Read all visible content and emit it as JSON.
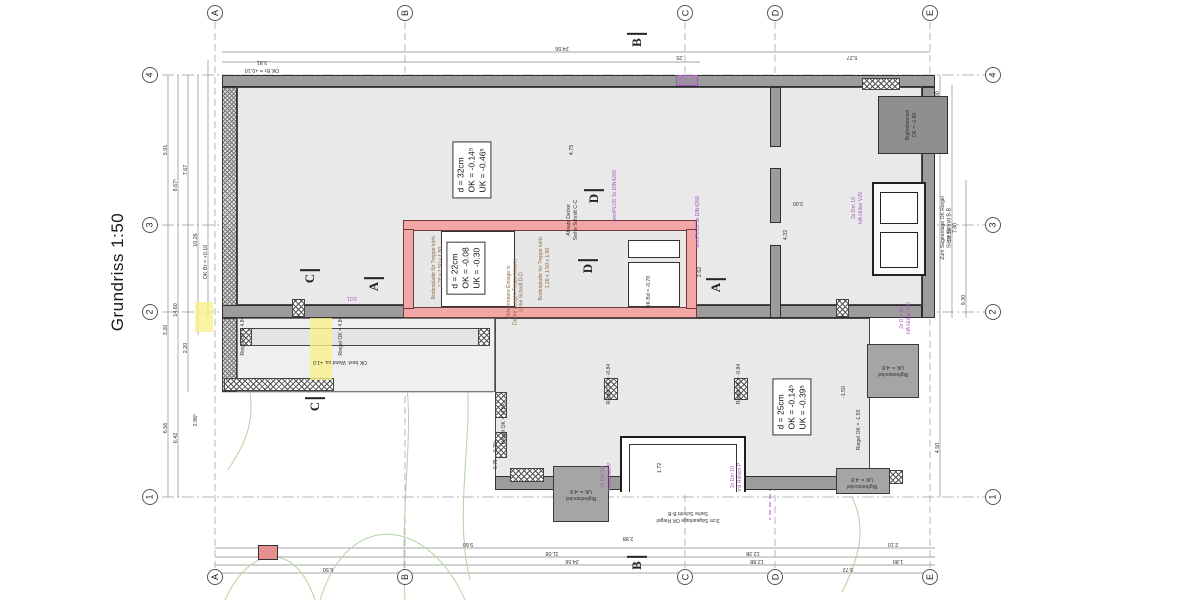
{
  "title": "Grundriss 1:50",
  "colors": {
    "new_construction_pink": "#f2a6a6",
    "existing_wall_gray": "#9c9c9c",
    "annotation_purple": "#a855c0",
    "highlight_yellow": "#f6ef9f",
    "contour_green": "#aed6a0"
  },
  "grid": {
    "cols": [
      {
        "label": "A",
        "x": 215
      },
      {
        "label": "B",
        "x": 405
      },
      {
        "label": "C",
        "x": 685
      },
      {
        "label": "D",
        "x": 775
      },
      {
        "label": "E",
        "x": 930
      }
    ],
    "rows": [
      {
        "label": "4",
        "y": 75
      },
      {
        "label": "3",
        "y": 225
      },
      {
        "label": "2",
        "y": 312
      },
      {
        "label": "1",
        "y": 497
      }
    ]
  },
  "annotation_boxes": [
    {
      "lines": "d = 32cm\nOK = -0.14⁵\nUK = -0.46⁵",
      "cx": 472,
      "cy": 170
    },
    {
      "lines": "d = 22cm\nOK = -0.08\nUK = -0.30",
      "cx": 466,
      "cy": 268
    },
    {
      "lines": "d = 25cm\nOK = -0.14⁵\nUK = -0.39⁵",
      "cx": 792,
      "cy": 407
    }
  ],
  "section_markers": [
    {
      "label": "B",
      "x": 637,
      "y": 40
    },
    {
      "label": "B",
      "x": 637,
      "y": 563
    },
    {
      "label": "C",
      "x": 310,
      "y": 276
    },
    {
      "label": "C",
      "x": 315,
      "y": 404
    },
    {
      "label": "A",
      "x": 374,
      "y": 284
    },
    {
      "label": "A",
      "x": 716,
      "y": 285
    },
    {
      "label": "D",
      "x": 594,
      "y": 196
    },
    {
      "label": "D",
      "x": 588,
      "y": 266
    }
  ],
  "dimensions": [
    {
      "t": "24.56",
      "x": 562,
      "y": 48,
      "r": 180
    },
    {
      "t": "5.27",
      "x": 852,
      "y": 57,
      "r": 180
    },
    {
      "t": ".25",
      "x": 680,
      "y": 57,
      "r": 180
    },
    {
      "t": "3.81",
      "x": 262,
      "y": 62,
      "r": 180
    },
    {
      "t": "OK Br = +0.10",
      "x": 262,
      "y": 70,
      "r": 180
    },
    {
      "t": "9.60",
      "x": 468,
      "y": 544,
      "r": 180
    },
    {
      "t": "2.10",
      "x": 893,
      "y": 544,
      "r": 180
    },
    {
      "t": "11.08",
      "x": 552,
      "y": 553,
      "r": 180
    },
    {
      "t": "12.38",
      "x": 753,
      "y": 553,
      "r": 180
    },
    {
      "t": "24.56",
      "x": 572,
      "y": 561,
      "r": 180
    },
    {
      "t": "12.88",
      "x": 757,
      "y": 561,
      "r": 180
    },
    {
      "t": "6.50",
      "x": 328,
      "y": 569,
      "r": 180
    },
    {
      "t": "9.72",
      "x": 848,
      "y": 569,
      "r": 180
    },
    {
      "t": "1.80",
      "x": 898,
      "y": 561,
      "r": 180
    },
    {
      "t": "2.88",
      "x": 628,
      "y": 538,
      "r": 180
    },
    {
      "t": "5.91",
      "x": 166,
      "y": 150,
      "r": -90
    },
    {
      "t": "7.67",
      "x": 186,
      "y": 170,
      "r": -90
    },
    {
      "t": "8.67⁵",
      "x": 176,
      "y": 185,
      "r": -90
    },
    {
      "t": "10.26",
      "x": 196,
      "y": 240,
      "r": -90
    },
    {
      "t": "OK Br = +0.10",
      "x": 206,
      "y": 262,
      "r": -90
    },
    {
      "t": "14.60",
      "x": 176,
      "y": 310,
      "r": -90
    },
    {
      "t": "3.20",
      "x": 166,
      "y": 330,
      "r": -90
    },
    {
      "t": "2.20",
      "x": 186,
      "y": 348,
      "r": -90
    },
    {
      "t": "6.56",
      "x": 166,
      "y": 428,
      "r": -90
    },
    {
      "t": "6.42",
      "x": 176,
      "y": 438,
      "r": -90
    },
    {
      "t": "2.86⁵",
      "x": 196,
      "y": 420,
      "r": -90
    },
    {
      "t": ".90",
      "x": 938,
      "y": 95,
      "r": -90
    },
    {
      "t": "10.50",
      "x": 950,
      "y": 235,
      "r": -90
    },
    {
      "t": "9.30",
      "x": 964,
      "y": 300,
      "r": -90
    },
    {
      "t": "4.50",
      "x": 938,
      "y": 448,
      "r": -90
    },
    {
      "t": "4.75",
      "x": 572,
      "y": 150,
      "r": -90
    },
    {
      "t": "4.32",
      "x": 786,
      "y": 235,
      "r": -90
    },
    {
      "t": "3.00",
      "x": 798,
      "y": 203,
      "r": 180
    },
    {
      "t": "1.72",
      "x": 660,
      "y": 468,
      "r": -90
    },
    {
      "t": "2.52",
      "x": 700,
      "y": 272,
      "r": -90
    }
  ],
  "notes": [
    {
      "t": "amoPLUS 3x DIN4269",
      "x": 616,
      "y": 196,
      "r": -90,
      "c": "purple"
    },
    {
      "t": "amoPLUS 3x DIN4269",
      "x": 699,
      "y": 222,
      "r": -90,
      "c": "purple"
    },
    {
      "t": "2x Dm 10\nHA Hülse V20",
      "x": 858,
      "y": 208,
      "r": -90,
      "c": "purple"
    },
    {
      "t": "2x Dm 10\nHA Hülse V20",
      "x": 906,
      "y": 318,
      "r": -90,
      "c": "purple"
    },
    {
      "t": "2x Dm 10\nmit Hülsen P",
      "x": 607,
      "y": 477,
      "r": -90,
      "c": "purple"
    },
    {
      "t": "2x Dm 10\nmit Hülsen P",
      "x": 737,
      "y": 477,
      "r": -90,
      "c": "purple"
    },
    {
      "t": "3.01",
      "x": 352,
      "y": 297,
      "r": 180,
      "c": "purple"
    },
    {
      "t": "Bodenplatte für Treppe kürb.\n1.20 x 1.50 x 1.50",
      "x": 438,
      "y": 267,
      "r": -90,
      "c": "brown"
    },
    {
      "t": "Bodenplatte für Treppe kürb.\n1.20 x 1.50 x 1.50",
      "x": 545,
      "y": 268,
      "r": -90,
      "c": "brown"
    },
    {
      "t": "Abnehmbare Einlage in\nDecke (wegen Treppenraum)\nsiehe Schnitt D-D",
      "x": 516,
      "y": 292,
      "r": -90,
      "c": "brown"
    },
    {
      "t": "Absatz Decke\nSiehe Schnitt C-C",
      "x": 573,
      "y": 220,
      "r": -90,
      "c": "dark"
    },
    {
      "t": "OK best. Wand ca. +1.0",
      "x": 340,
      "y": 361,
      "r": 180,
      "c": "dark"
    },
    {
      "t": "Zum Sägeanlage OK Riegel\nSiehe Schnitt B-B\n7.90",
      "x": 950,
      "y": 228,
      "r": -90,
      "c": "dark"
    },
    {
      "t": "2cm Sägeanlage OK Riegel\nSiehe Schnitt B-B",
      "x": 688,
      "y": 516,
      "r": 180,
      "c": "dark"
    },
    {
      "t": "Bigfootsockel\nUK = -4.8",
      "x": 893,
      "y": 370,
      "r": 180,
      "c": "dark"
    },
    {
      "t": "Bigfootsockel\nUK = -4.8",
      "x": 862,
      "y": 482,
      "r": 180,
      "c": "dark"
    },
    {
      "t": "Bigfootsockel\nUK = -4.8",
      "x": 581,
      "y": 494,
      "r": 180,
      "c": "dark"
    },
    {
      "t": "Bigfootsockel\nOK = -1.80",
      "x": 912,
      "y": 125,
      "r": -90,
      "c": "dark"
    },
    {
      "t": "Riegel UK = -0.84",
      "x": 610,
      "y": 384,
      "r": -90,
      "c": "dark"
    },
    {
      "t": "Riegel UK = -0.84",
      "x": 740,
      "y": 384,
      "r": -90,
      "c": "dark"
    },
    {
      "t": "Riegel OK = -4.84",
      "x": 505,
      "y": 424,
      "r": -90,
      "c": "dark"
    },
    {
      "t": "Riegel OK = -1.50",
      "x": 860,
      "y": 430,
      "r": -90,
      "c": "dark"
    },
    {
      "t": "Riegel OK = 4.84",
      "x": 244,
      "y": 336,
      "r": -90,
      "c": "dark"
    },
    {
      "t": "Riegel OK = 4.84",
      "x": 342,
      "y": 336,
      "r": -90,
      "c": "dark"
    },
    {
      "t": "UK Bd = -0.78",
      "x": 650,
      "y": 292,
      "r": -90,
      "c": "dark"
    },
    {
      "t": "-0.30⁵",
      "x": 497,
      "y": 447,
      "r": -90,
      "c": "dark"
    },
    {
      "t": "-0.75",
      "x": 497,
      "y": 465,
      "r": -90,
      "c": "dark"
    },
    {
      "t": "-1.50",
      "x": 845,
      "y": 392,
      "r": -90,
      "c": "dark"
    }
  ]
}
